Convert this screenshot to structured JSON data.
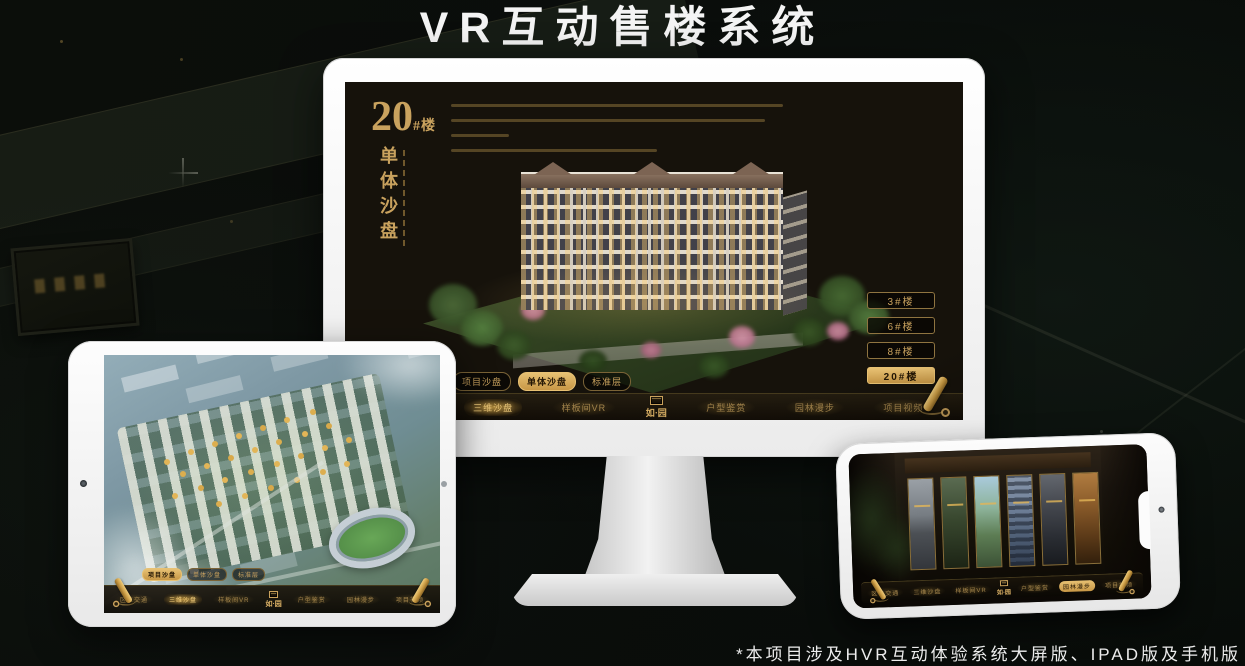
{
  "header": {
    "title": "VR互动售楼系统"
  },
  "footer": {
    "note": "*本项目涉及HVR互动体验系统大屏版、IPAD版及手机版"
  },
  "colors": {
    "gold": "#c9a25e",
    "gold_active": "#e7c173",
    "screen_bg": "#16120b",
    "frame_white": "#f4f4f4"
  },
  "sandbox_ui": {
    "logo": "如·园",
    "block": {
      "number": "20",
      "suffix": "#楼",
      "title": "单体沙盘"
    },
    "mode_tabs": [
      {
        "label": "项目沙盘"
      },
      {
        "label": "单体沙盘"
      },
      {
        "label": "标准层"
      }
    ],
    "nav_items": [
      {
        "label": "区位交通"
      },
      {
        "label": "三维沙盘"
      },
      {
        "label": "样板间VR"
      },
      {
        "label": "户型鉴赏"
      },
      {
        "label": "园林漫步"
      },
      {
        "label": "项目视频"
      }
    ],
    "floor_buttons": [
      {
        "label": "3#楼"
      },
      {
        "label": "6#楼"
      },
      {
        "label": "8#楼"
      },
      {
        "label": "20#楼"
      }
    ]
  }
}
